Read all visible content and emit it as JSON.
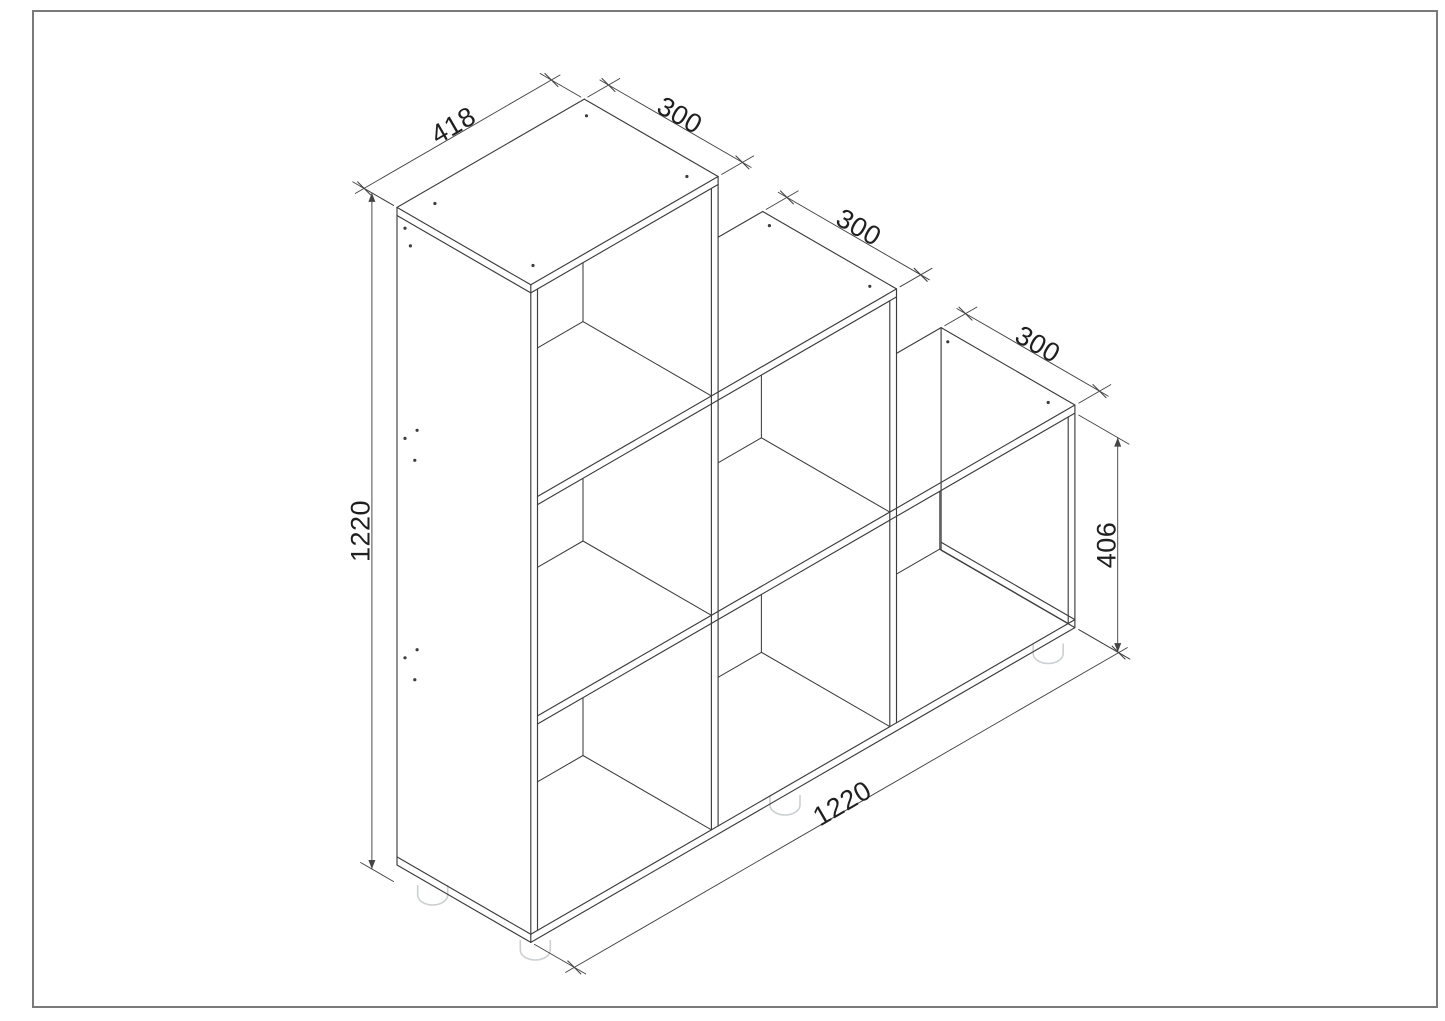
{
  "drawing": {
    "kind": "isometric furniture technical drawing",
    "subject": "three-step cube shelf unit"
  },
  "dims": {
    "d418": "418",
    "d300a": "300",
    "d300b": "300",
    "d300c": "300",
    "h1220": "1220",
    "h406": "406",
    "w1220": "1220"
  },
  "model_mm": {
    "overall_width": 1220,
    "overall_height": 1220,
    "depth": 300,
    "cube_opening": 300,
    "step_height": 406,
    "col1_top_width": 418,
    "panel_thickness": 15
  },
  "colors": {
    "line": "#3d3d3d",
    "dim_line": "#444444",
    "text": "#1f1f1f",
    "feet": "#cbd0d2",
    "border": "#7a7a7a",
    "background": "#ffffff"
  }
}
